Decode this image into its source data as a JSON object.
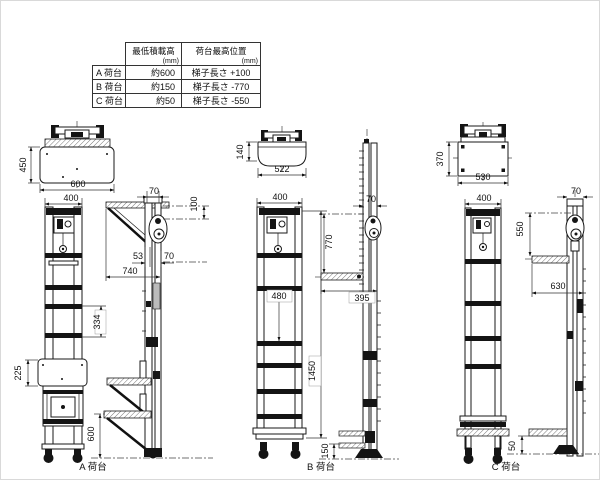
{
  "table": {
    "header": [
      {
        "label": "最低積載高",
        "unit": "(mm)"
      },
      {
        "label": "荷台最高位置",
        "unit": "(mm)"
      }
    ],
    "rows": [
      {
        "name": "A 荷台",
        "min_load_height": "約600",
        "max_platform_pos": "梯子長さ +100"
      },
      {
        "name": "B 荷台",
        "min_load_height": "約150",
        "max_platform_pos": "梯子長さ -770"
      },
      {
        "name": "C 荷台",
        "min_load_height": "約50",
        "max_platform_pos": "梯子長さ -550"
      }
    ]
  },
  "drawings": {
    "a": {
      "caption": "A 荷台",
      "dims": {
        "d450": "450",
        "d600_top": "600",
        "d400": "400",
        "d334": "334",
        "d225": "225",
        "d70_top": "70",
        "d100": "100",
        "d53": "53",
        "d740": "740",
        "d70_side": "70",
        "d600_side": "600"
      }
    },
    "b": {
      "caption": "B 荷台",
      "dims": {
        "d140": "140",
        "d522": "522",
        "d400": "400",
        "d480": "480",
        "d1450": "1450",
        "d70": "70",
        "d770": "770",
        "d395": "395",
        "d150": "150"
      }
    },
    "c": {
      "caption": "C 荷台",
      "dims": {
        "d370": "370",
        "d530": "530",
        "d400": "400",
        "d70": "70",
        "d550": "550",
        "d630": "630",
        "d50": "50"
      }
    }
  }
}
